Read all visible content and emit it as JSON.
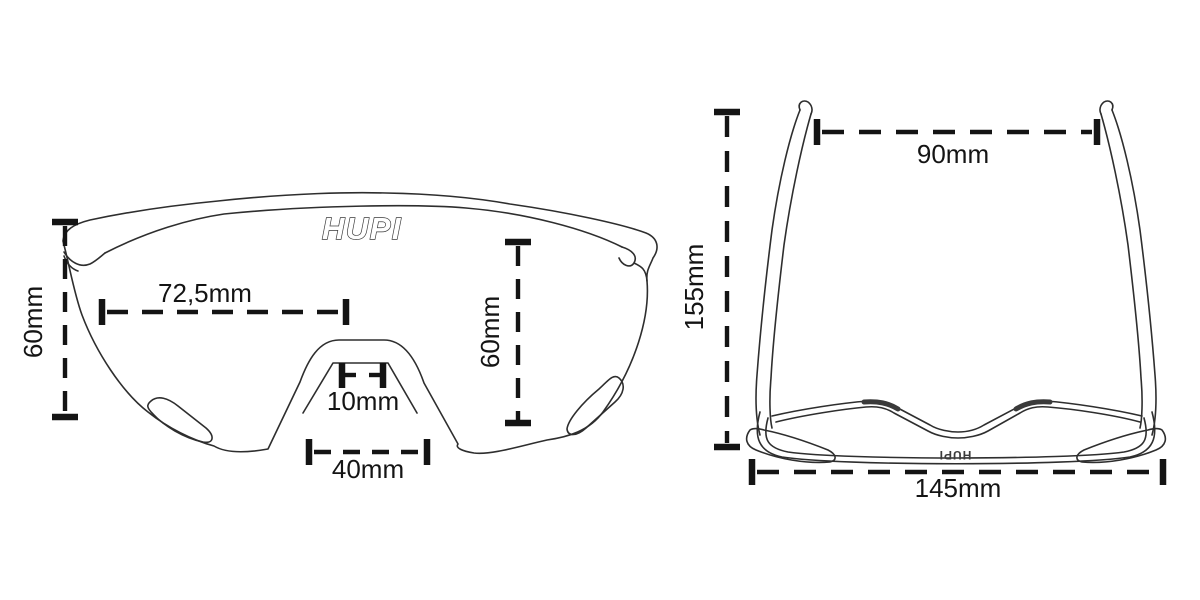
{
  "diagram": {
    "subject": "sunglasses-measurement-diagram",
    "brand": "HUPI",
    "colors": {
      "background": "#ffffff",
      "line_art": "#2e2e2e",
      "dimension": "#141414"
    },
    "front_view": {
      "logo": "HUPI",
      "dimensions": {
        "frame_height": "60mm",
        "lens_width": "72,5mm",
        "lens_height": "60mm",
        "bridge_width": "10mm",
        "nose_cutout_width": "40mm"
      }
    },
    "top_view": {
      "frame_logo": "HUPI",
      "dimensions": {
        "temple_tip_spread": "90mm",
        "temple_length": "155mm",
        "total_width": "145mm"
      }
    }
  }
}
